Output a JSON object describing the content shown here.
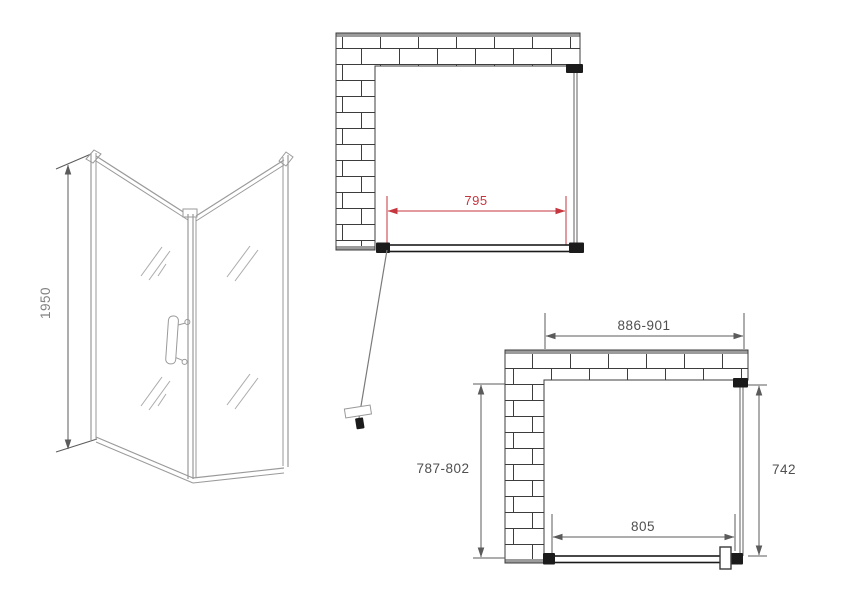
{
  "drawing": {
    "iso_view": {
      "height_label": "1950"
    },
    "top_plan": {
      "width_label": "795"
    },
    "bottom_plan": {
      "top_width_label": "886-901",
      "left_depth_label": "787-802",
      "right_depth_label": "742",
      "bottom_width_label": "805"
    }
  },
  "colors": {
    "background": "#ffffff",
    "wall_line": "#3d3d3d",
    "wall_cap": "#9b9b9b",
    "panel_gray": "#7a7a7a",
    "iso_gray": "#9a9a9a",
    "door_dark": "#1b1b1b",
    "dim_gray": "#5b5b5b",
    "dim_text": "#4f4f4f",
    "dim_red": "#c6363f",
    "iso_text": "#828282"
  }
}
